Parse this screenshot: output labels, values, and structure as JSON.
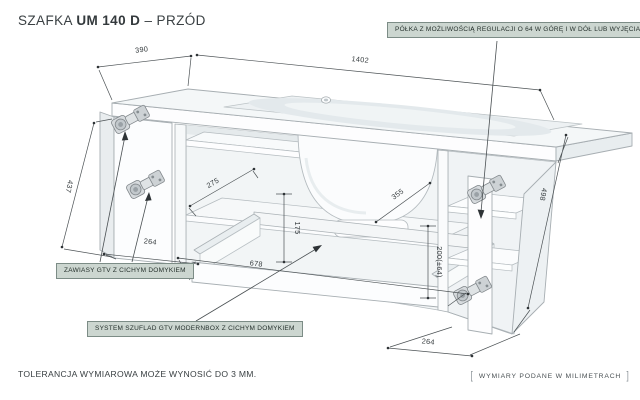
{
  "title": {
    "prefix": "SZAFKA",
    "model": "UM 140 D",
    "sep": "–",
    "view": "PRZÓD"
  },
  "callouts": {
    "shelf": "PÓŁKA Z MOŻLIWOŚCIĄ REGULACJI O 64 W GÓRĘ I W DÓŁ LUB WYJĘCIA",
    "hinges": "ZAWIASY GTV Z CICHYM DOMYKIEM",
    "drawers": "SYSTEM SZUFLAD GTV MODERNBOX Z CICHYM DOMYKIEM"
  },
  "dims": {
    "top_depth": "390",
    "top_width": "1402",
    "left_door_height": "437",
    "drawer_side_depth": "275",
    "drawer_inner_height": "175",
    "left_door_width": "264",
    "drawer_front_width": "678",
    "shelf_depth": "355",
    "shelf_adjust_range": "200(±64)",
    "right_door_width": "264",
    "carcass_height": "498"
  },
  "footer": {
    "tolerance": "TOLERANCJA WYMIAROWA MOŻE WYNOSIĆ DO 3 MM.",
    "units_note": "WYMIARY PODANE W MILIMETRACH",
    "bracket_open": "[",
    "bracket_close": "]"
  },
  "colors": {
    "callout_bg": "#ccd6d0",
    "callout_border": "#7c8c86",
    "ink": "#3a4043",
    "drawing_edge": "#a9b0b4",
    "dimension_line": "#4c5255"
  }
}
